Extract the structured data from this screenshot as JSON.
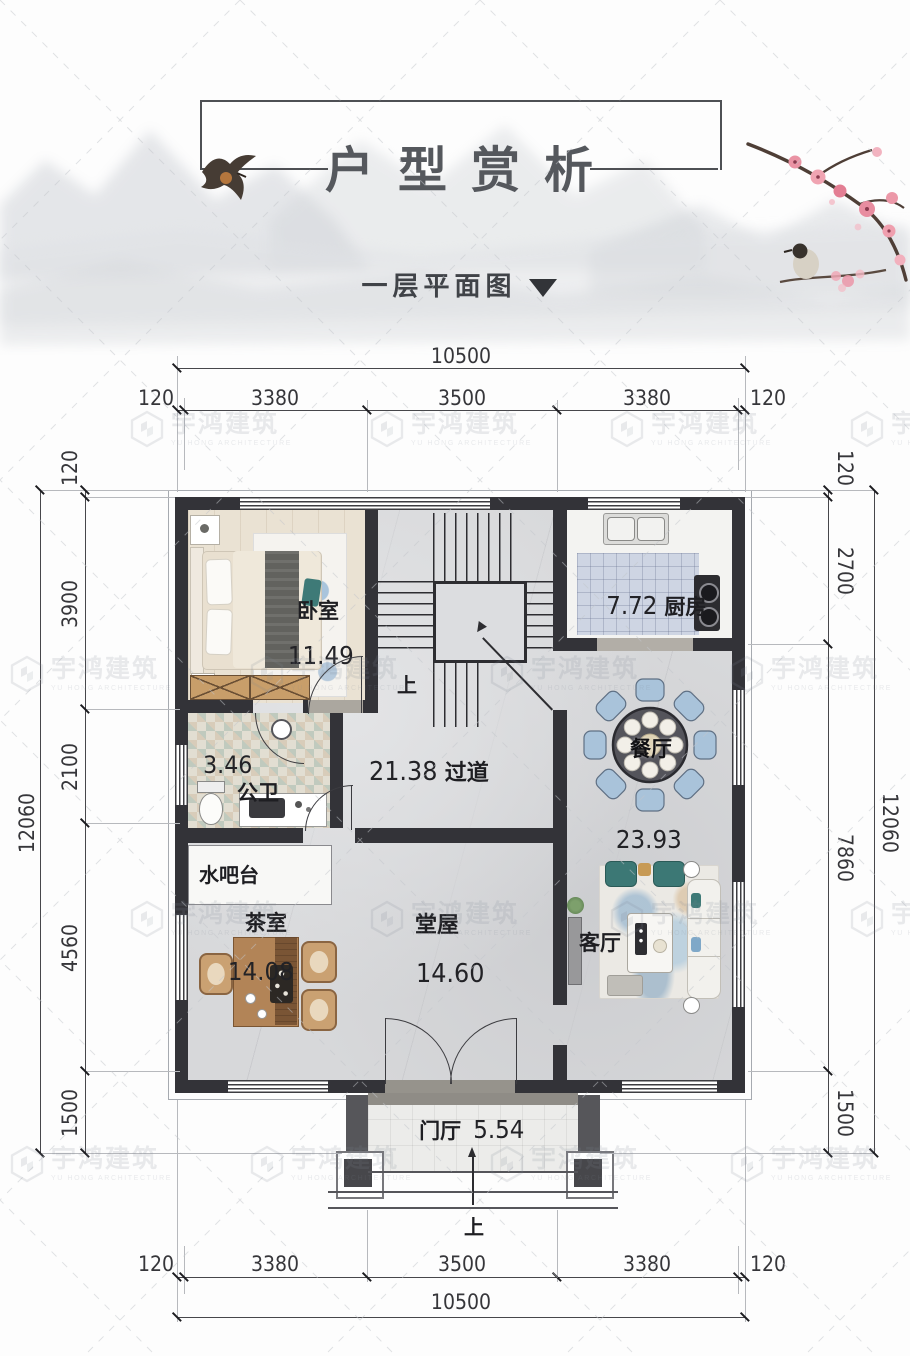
{
  "header": {
    "title": "户型赏析",
    "subtitle": "一层平面图"
  },
  "watermark": {
    "name": "宇鸿建筑",
    "subtitle": "YU HONG ARCHITECTURE"
  },
  "plan": {
    "rooms": {
      "bedroom": {
        "label": "卧室",
        "area": "11.49"
      },
      "kitchen": {
        "label": "厨房",
        "area": "7.72"
      },
      "bathroom": {
        "label": "公卫",
        "area": "3.46"
      },
      "hallway": {
        "label": "过道",
        "area": "21.38"
      },
      "dining": {
        "label": "餐厅",
        "area": "23.93"
      },
      "water_bar": {
        "label": "水吧台"
      },
      "tea_room": {
        "label": "茶室",
        "area": "14.08"
      },
      "main_hall": {
        "label": "堂屋",
        "area": "14.60"
      },
      "living": {
        "label": "客厅"
      },
      "foyer": {
        "label": "门厅",
        "area": "5.54"
      }
    },
    "stairs_up_label": "上",
    "entry_up_label": "上"
  },
  "dimensions": {
    "top": {
      "overall": "10500",
      "segments": [
        "120",
        "3380",
        "3500",
        "3380",
        "120"
      ]
    },
    "bottom": {
      "overall": "10500",
      "segments": [
        "120",
        "3380",
        "3500",
        "3380",
        "120"
      ]
    },
    "left": {
      "overall": "12060",
      "segments": [
        "120",
        "3900",
        "2100",
        "4560",
        "1500"
      ]
    },
    "right": {
      "overall": "12060",
      "segments": [
        "120",
        "2700",
        "7860",
        "1500"
      ]
    }
  }
}
